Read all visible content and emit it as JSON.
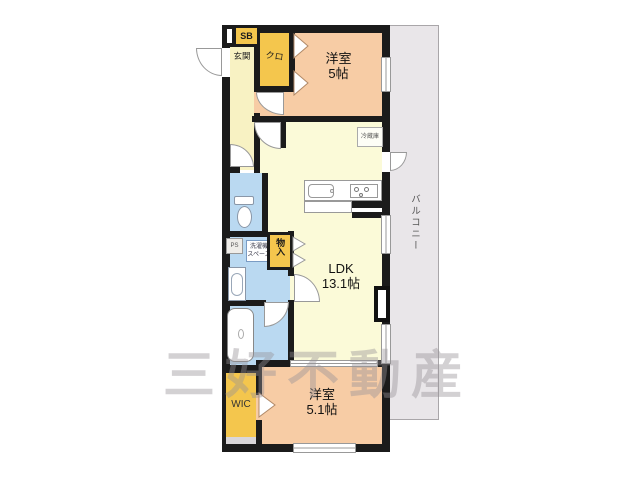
{
  "plan": {
    "watermark": "三好不動産",
    "balcony": {
      "label": "バルコニー"
    },
    "entrance": {
      "label": "玄関",
      "shoe_box_label": "SB"
    },
    "closet": {
      "label": "クロ"
    },
    "bedroom1": {
      "name": "洋室",
      "size": "5帖"
    },
    "ldk": {
      "name": "LDK",
      "size": "13.1帖",
      "refrigerator_label": "冷蔵庫"
    },
    "storage": {
      "label": "物入"
    },
    "utility": {
      "pipe_space_label": "PS",
      "washer_line1": "洗濯機",
      "washer_line2": "スペース"
    },
    "wic": {
      "label": "WIC"
    },
    "bedroom2": {
      "name": "洋室",
      "size": "5.1帖"
    },
    "colors": {
      "wall": "#1b1b1b",
      "bedroom_fill": "#f7cca5",
      "ldk_fill": "#fbfad8",
      "hall_fill": "#f8f2c3",
      "closet_fill": "#f4c64d",
      "wet_area_fill": "#bad9f1",
      "balcony_fill": "#e9e6e9",
      "watermark_color": "#9b969b"
    }
  }
}
